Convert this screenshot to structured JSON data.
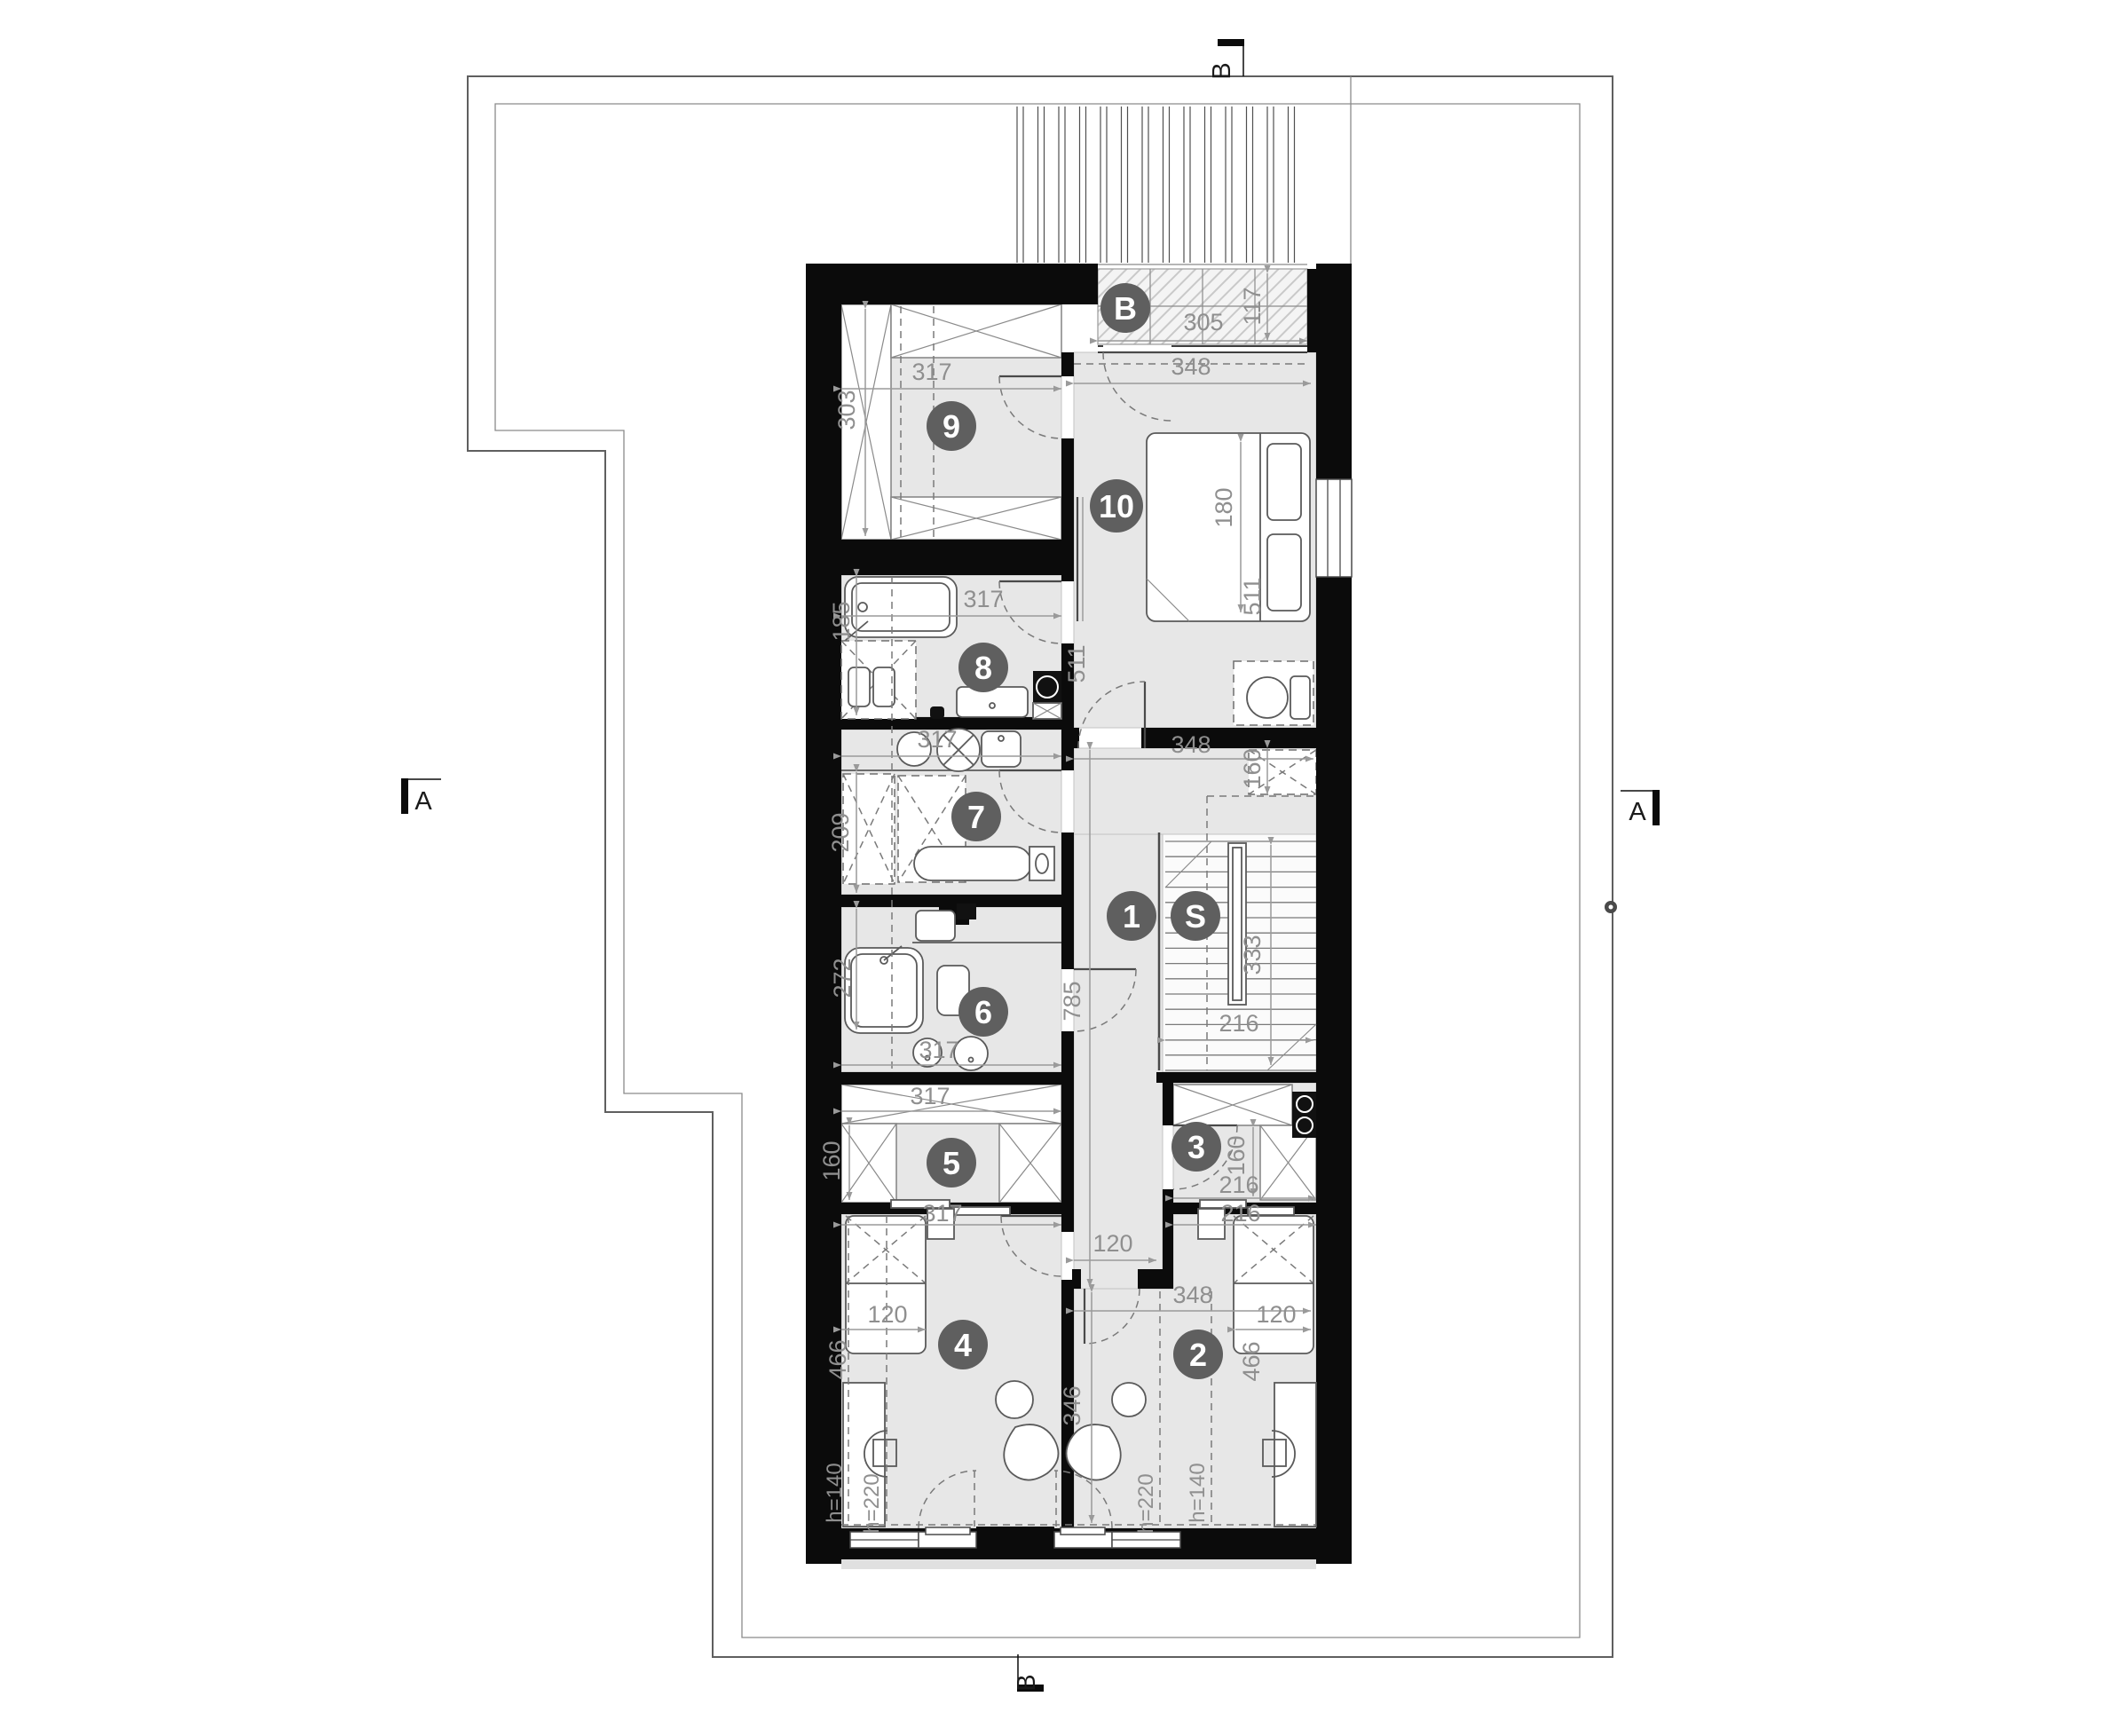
{
  "plan_title": "Upper floor plan",
  "colors": {
    "wall": "#0b0b0b",
    "floor": "#e7e7e7",
    "badge": "#5f5f5f",
    "dim_text": "#8f8f8f",
    "site_line": "#5f5f5f"
  },
  "badges": {
    "r1": "1",
    "r2": "2",
    "r3": "3",
    "r4": "4",
    "r5": "5",
    "r6": "6",
    "r7": "7",
    "r8": "8",
    "r9": "9",
    "r10": "10",
    "stairs": "S",
    "balcony": "B"
  },
  "sections": {
    "a_left": "A",
    "a_right": "A",
    "b_top": "B",
    "b_bottom": "B"
  },
  "dims": {
    "balcony_w": "305",
    "balcony_d": "117",
    "r9_w": "317",
    "r9_d": "303",
    "r10_w": "348",
    "r10_bed": "180",
    "r10_d1": "511",
    "r10_d2": "511",
    "hall_w": "348",
    "closet_d": "160",
    "r8_w": "317",
    "r8_d": "185",
    "r7_w": "317",
    "r7_d": "209",
    "r6_w": "317",
    "r6_d": "272",
    "corr_len": "785",
    "corr_w": "120",
    "stair_w": "216",
    "stair_len": "333",
    "r5_w1": "317",
    "r5_d": "160",
    "r5_w2": "317",
    "r3_w1": "216",
    "r3_d": "160",
    "r3_w2": "216",
    "r4_bed": "120",
    "r4_d": "466",
    "r4_h1": "h=140",
    "r4_h2": "h=220",
    "r2_w": "348",
    "r2_bed": "120",
    "r2_d": "466",
    "r2_len": "346",
    "r2_h1": "h=220",
    "r2_h2": "h=140"
  }
}
